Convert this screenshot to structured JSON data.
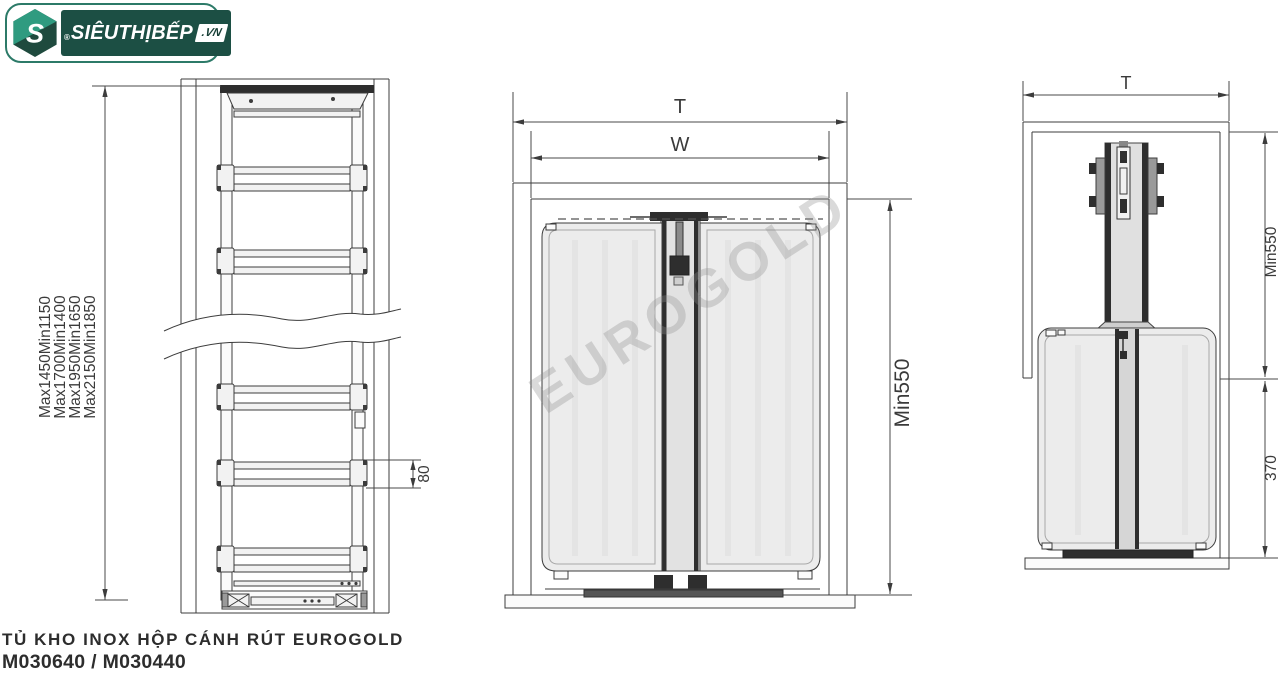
{
  "brand": {
    "registered_mark": "®",
    "name": "SIÊUTHỊBẾP",
    "domain_suffix": ".VN",
    "monogram": "S"
  },
  "watermark": "EUROGOLD",
  "product": {
    "title": "TỦ KHO INOX HỘP CÁNH RÚT EUROGOLD",
    "codes": "M030640 / M030440"
  },
  "front_view": {
    "height_options": [
      "Max1450Min1150",
      "Max1700Min1400",
      "Max1950Min1650",
      "Max2150Min1850"
    ],
    "rail_gap": "80"
  },
  "front_open_view": {
    "total_width": "T",
    "cabinet_width": "W",
    "min_height": "Min550"
  },
  "side_view": {
    "total_depth": "T",
    "min_height": "Min550",
    "basket_zone_height": "370"
  },
  "colors": {
    "brand_dark_green": "#1c4f44",
    "brand_teal": "#2f9b80",
    "logo_border_green": "#2c7a68",
    "diagram_line": "#3c3c3c",
    "panel_fill": "#ececec",
    "watermark_gray": "#c9c9c9"
  }
}
